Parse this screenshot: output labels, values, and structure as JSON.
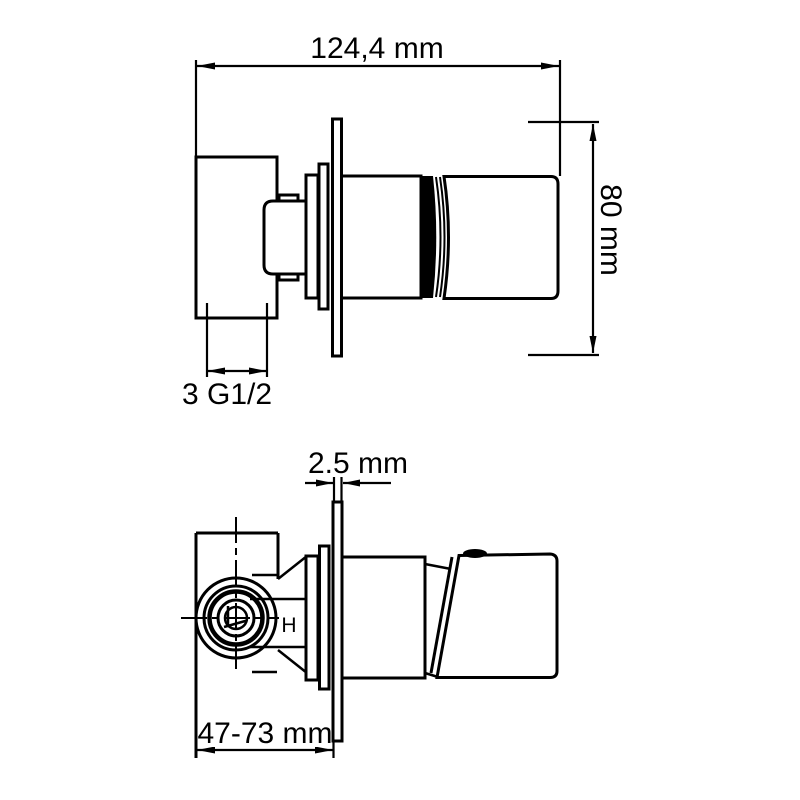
{
  "canvas": {
    "background": "#ffffff",
    "line_color": "#000000"
  },
  "side_view": {
    "width_dim_label": "124,4 mm",
    "height_dim_label": "80 mm",
    "thread_dim_label": "3 G1/2"
  },
  "plan_view": {
    "plate_thickness_label": "2.5 mm",
    "depth_range_label": "47-73 mm",
    "hot_water_label": "H"
  }
}
